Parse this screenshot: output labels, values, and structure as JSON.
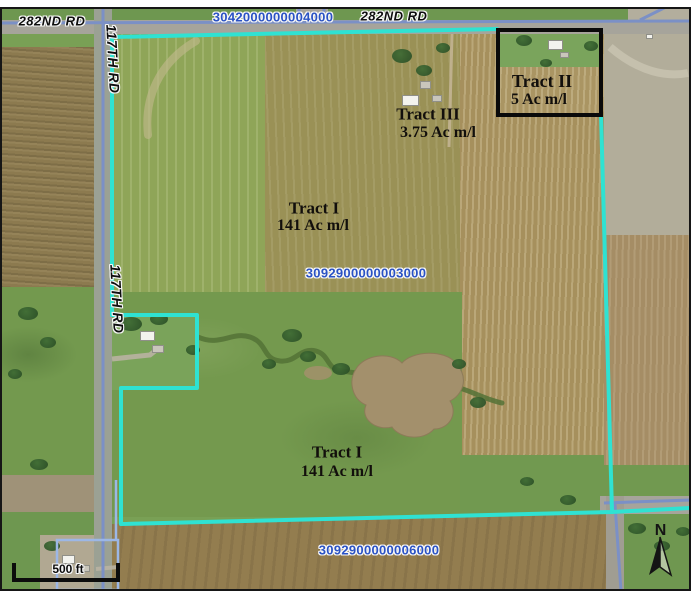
{
  "roads": {
    "r282_left": "282ND RD",
    "r282_right": "282ND RD",
    "r117_top": "117TH RD",
    "r117_mid": "117TH RD"
  },
  "parcels": {
    "north_id": "3042000000004000",
    "central_id": "3092900000003000",
    "south_id": "3092900000006000"
  },
  "tracts": {
    "t1_upper_name": "Tract I",
    "t1_upper_acres": "141 Ac m/l",
    "t1_lower_name": "Tract I",
    "t1_lower_acres": "141 Ac m/l",
    "t2_name": "Tract II",
    "t2_acres": "5 Ac m/l",
    "t3_name": "Tract III",
    "t3_acres": "3.75 Ac m/l"
  },
  "scale_bar": {
    "label": "500 ft"
  },
  "compass": {
    "label": "N"
  },
  "colors": {
    "tract_boundary": "#2fe2d2",
    "road_centerline": "#7b90c6",
    "parcel_label_text": "#2a52c4",
    "tract2_box": "#000000"
  }
}
